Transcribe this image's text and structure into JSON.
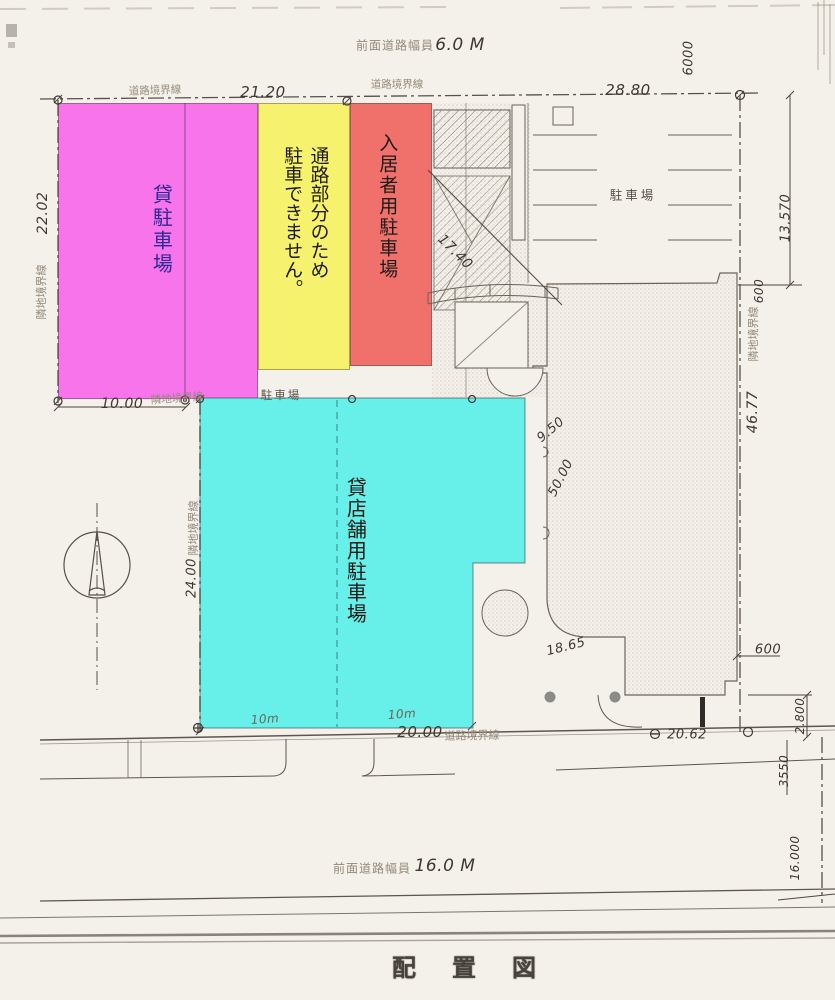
{
  "doc": {
    "title": "配置図"
  },
  "roads": {
    "top_label": "前面道路幅員",
    "top_value": "6.0 M",
    "bottom_label": "前面道路幅員",
    "bottom_value": "16.0 M"
  },
  "areas": {
    "rental": {
      "label": "貸駐車場",
      "color": "#f874eb",
      "text_color": "#2b2b91"
    },
    "passage": {
      "label": "通路部分のため駐車できません。",
      "line1": "通路部分のため",
      "line2": "駐車できません。",
      "color": "#f7f26d"
    },
    "resident": {
      "label": "入居者用駐車場",
      "color": "#f0716b"
    },
    "store": {
      "label": "貸店舗用駐車場",
      "color": "#67efe9"
    },
    "parking_lot_label": "駐車場",
    "parking_small_label": "駐車場"
  },
  "boundaries": {
    "top_left": "道路境界線",
    "top_mid": "道路境界線",
    "left": "隣地境界線",
    "left_bottom": "隣地境界線",
    "right": "隣地境界線",
    "cyan_left": "隣地境界線",
    "bottom": "道路境界線"
  },
  "dimensions": {
    "d6000": "6000",
    "d2120": "21.20",
    "d2880": "28.80",
    "d2202": "22.02",
    "d13570": "13.570",
    "d600_top": "600",
    "d4677": "46.77",
    "d1740": "17.40",
    "d1000": "10.00",
    "d950": "9.50",
    "d5000": "50.00",
    "d2400": "24.00",
    "d1865": "18.65",
    "d600_bottom": "600",
    "d2800": "2.800",
    "d10m_a": "10m",
    "d10m_b": "10m",
    "d2000": "20.00",
    "d2062": "20.62",
    "d3550": "3550",
    "d16000": "16.000"
  }
}
